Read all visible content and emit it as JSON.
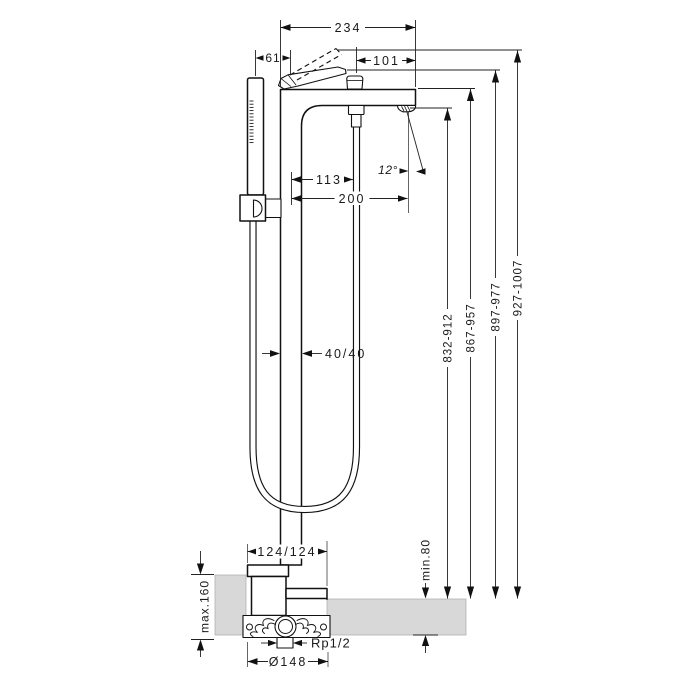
{
  "drawing": {
    "type": "technical-installation-drawing",
    "subject": "freestanding bath mixer with handshower",
    "colors": {
      "line": "#1a1a1a",
      "floor_fill": "#d8d8d8"
    }
  },
  "dims": {
    "width_total": "234",
    "spout_to_edge": "101",
    "handshower_offset": "61",
    "riser_to_hose": "113",
    "riser_to_spout": "200",
    "stream_angle": "12°",
    "column_profile": "40/40",
    "height_spout": "832-912",
    "height_deck": "867-957",
    "height_lever": "897-977",
    "height_lever_raised": "927-1007",
    "base_plate": "124/124",
    "floor_min": "min.80",
    "floor_max": "max.160",
    "thread": "Rp1/2",
    "flange_diameter": "Ø148"
  }
}
